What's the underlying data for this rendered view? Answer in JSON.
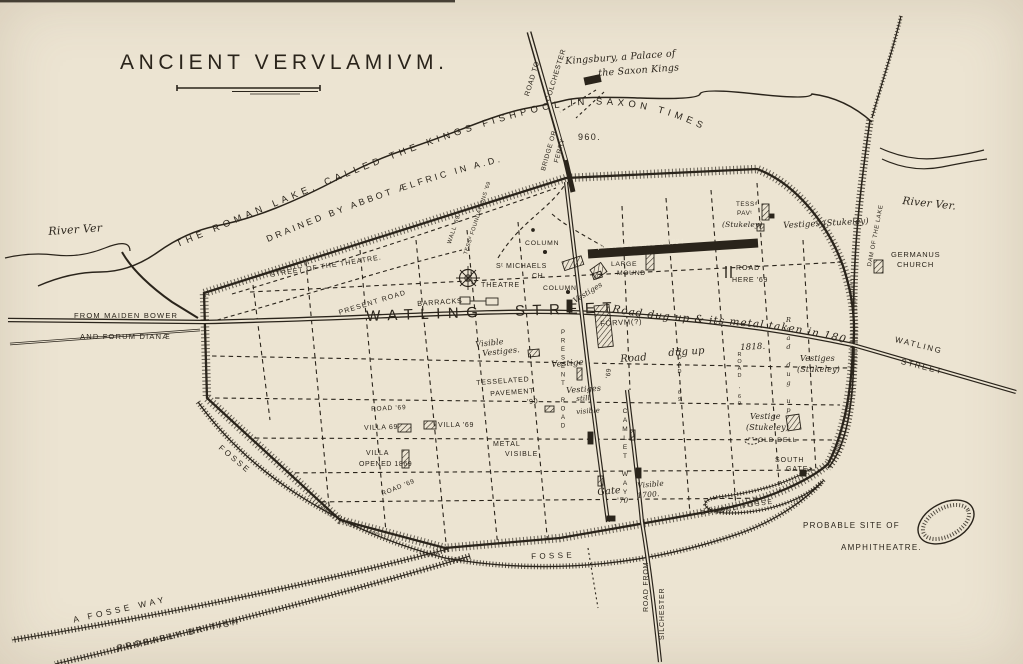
{
  "page": {
    "paper_color": "#ece4d2",
    "ink_color": "#2a241b",
    "description": "Antique engraved plan of the Roman city of Verulamium with lake, ramparts, street grid and excavation notes"
  },
  "labels": {
    "title": "ANCIENT VERVLAMIVM.",
    "road_to": "ROAD TO",
    "colchester": "COLCHESTER",
    "kingsbury_1": "Kingsbury, a Palace of",
    "kingsbury_2": "the Saxon Kings",
    "bridge_or": "BRIDGE OR",
    "ferry": "FERRY",
    "lake_arc_1": "THE ROMAN LAKE, CALLED THE KINGS FISHPOOL IN SAXON TIMES",
    "lake_arc_2": "DRAINED BY ABBOT ÆLFRIC IN A.D.",
    "lake_960": "960.",
    "river_ver_left": "River Ver",
    "from_maiden": "FROM MAIDEN BOWER",
    "forum_dianae": "AND FORUM DIANÆ",
    "street_theatre": "STREET OF THE THEATRE.",
    "present_road_diag": "PRESENT ROAD",
    "wall69": "WALL '69",
    "tess_found": "TESSᵈ FOUNDATIONS '69",
    "column_top": "COLUMN",
    "st_michaels_1": "Sᵗ MICHAELS",
    "st_michaels_2": "CH.",
    "theatre": "THEATRE",
    "column_low": "COLUMN",
    "barracks": "BARRACKS",
    "watling_main": "WATLING STREET",
    "opened_band": "Opened 1816 used to 1834",
    "large_mound_1": "LARGE",
    "large_mound_2": "MOUND",
    "tess_pav_1": "TESSᵈ",
    "tess_pav_2": "PAVᵗ",
    "tess_pav_3": "(Stukeley)",
    "vestiges_stukeley_top": "Vestiges (Stukeley)",
    "road_here_1": "ROAD",
    "road_here_2": "HERE '69",
    "road_dugup_arc": "Road dug up & its metal taken in 1800",
    "forum": "FORVM(?)",
    "vestige_mid": "Vestige",
    "tick69": "'69",
    "road_word": "Road",
    "dugup_word": "dug up",
    "y1818": "1818.",
    "vest_still_1": "Vestiges",
    "vest_still_2": "still",
    "visible_vestiges_1": "Visible",
    "visible_vestiges_2": "Vestiges.",
    "tessel_1": "TESSELATED",
    "tessel_2": "PAVEMENT",
    "tessel_3": "'90",
    "villa69_a": "VILLA 69",
    "villa69_b": "VILLA '69",
    "road69_h2": "ROAD '69",
    "villa_opened_1": "VILLA",
    "villa_opened_2": "OPENED 1869",
    "road69_diag": "ROAD '69",
    "metal_1": "METAL",
    "metal_2": "VISIBLE",
    "visible_small": "visible",
    "present_road_stack": "PRESENT ROAD",
    "camlet_stack": "CAMLET WAY",
    "road69_stack_a": "ROAD '69",
    "road69_stack_b": "ROAD '69",
    "road_dugup_stack": "Road dug up",
    "gate_word": "Gate",
    "gate_num": "'70",
    "visible_1700_1": "Visible",
    "visible_1700_2": "1700.",
    "south_gate_1": "SOUTH",
    "south_gate_2": "GATE",
    "vestige_stuk2_1": "Vestige",
    "vestige_stuk2_2": "(Stukeley)",
    "vestiges_stuk3_1": "Vestiges",
    "vestiges_stuk3_2": "(Stukeley)",
    "old_dell": "OLD DELL",
    "double_fosse": "DOUBLE FOSSE",
    "fosse_left": "FOSSE",
    "fosse_bottom": "FOSSE",
    "fosse_way": "A FOSSE WAY",
    "probably_british": "PROBABLY BRITISH",
    "road_from": "ROAD FROM",
    "silchester": "SILCHESTER",
    "probable_site": "PROBABLE SITE OF",
    "amphitheatre": "AMPHITHEATRE.",
    "dam_lake": "DAM OF THE LAKE",
    "river_ver_right": "River Ver.",
    "germanus_1": "GERMANUS",
    "germanus_2": "CHURCH",
    "watling_right_1": "WATLING",
    "watling_right_2": "STREET",
    "vestiges_col": "Vestiges"
  }
}
